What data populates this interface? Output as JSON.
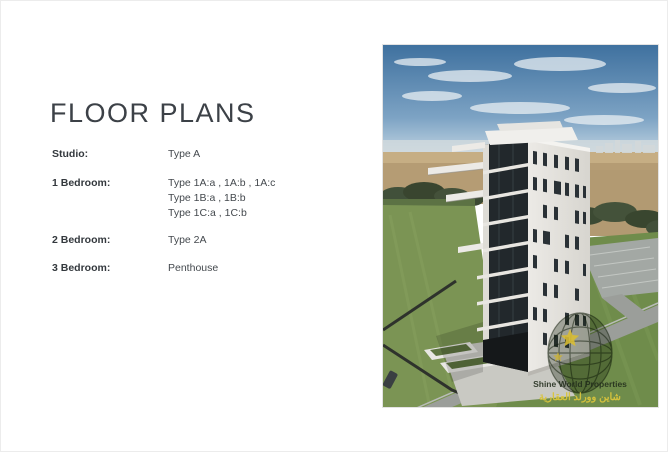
{
  "title": "FLOOR PLANS",
  "plans": {
    "rows": [
      {
        "label": "Studio:",
        "lines": [
          "Type A"
        ]
      },
      {
        "label": "1 Bedroom:",
        "lines": [
          "Type 1A:a , 1A:b , 1A:c",
          "Type 1B:a , 1B:b",
          "Type 1C:a , 1C:b"
        ]
      },
      {
        "label": "2 Bedroom:",
        "lines": [
          "Type 2A"
        ]
      },
      {
        "label": "3 Bedroom:",
        "lines": [
          "Penthouse"
        ]
      }
    ]
  },
  "rendering": {
    "watermark": {
      "icon": "globe-star-watermark",
      "name_en": "Shine World Properties",
      "name_ar": "شاين وورلد العقارية"
    }
  },
  "colors": {
    "text": "#3c4147",
    "sky": "#3f719f",
    "sand": "#b59c74",
    "grass": "#7b9454",
    "watermark_gold": "#d9c43c"
  }
}
